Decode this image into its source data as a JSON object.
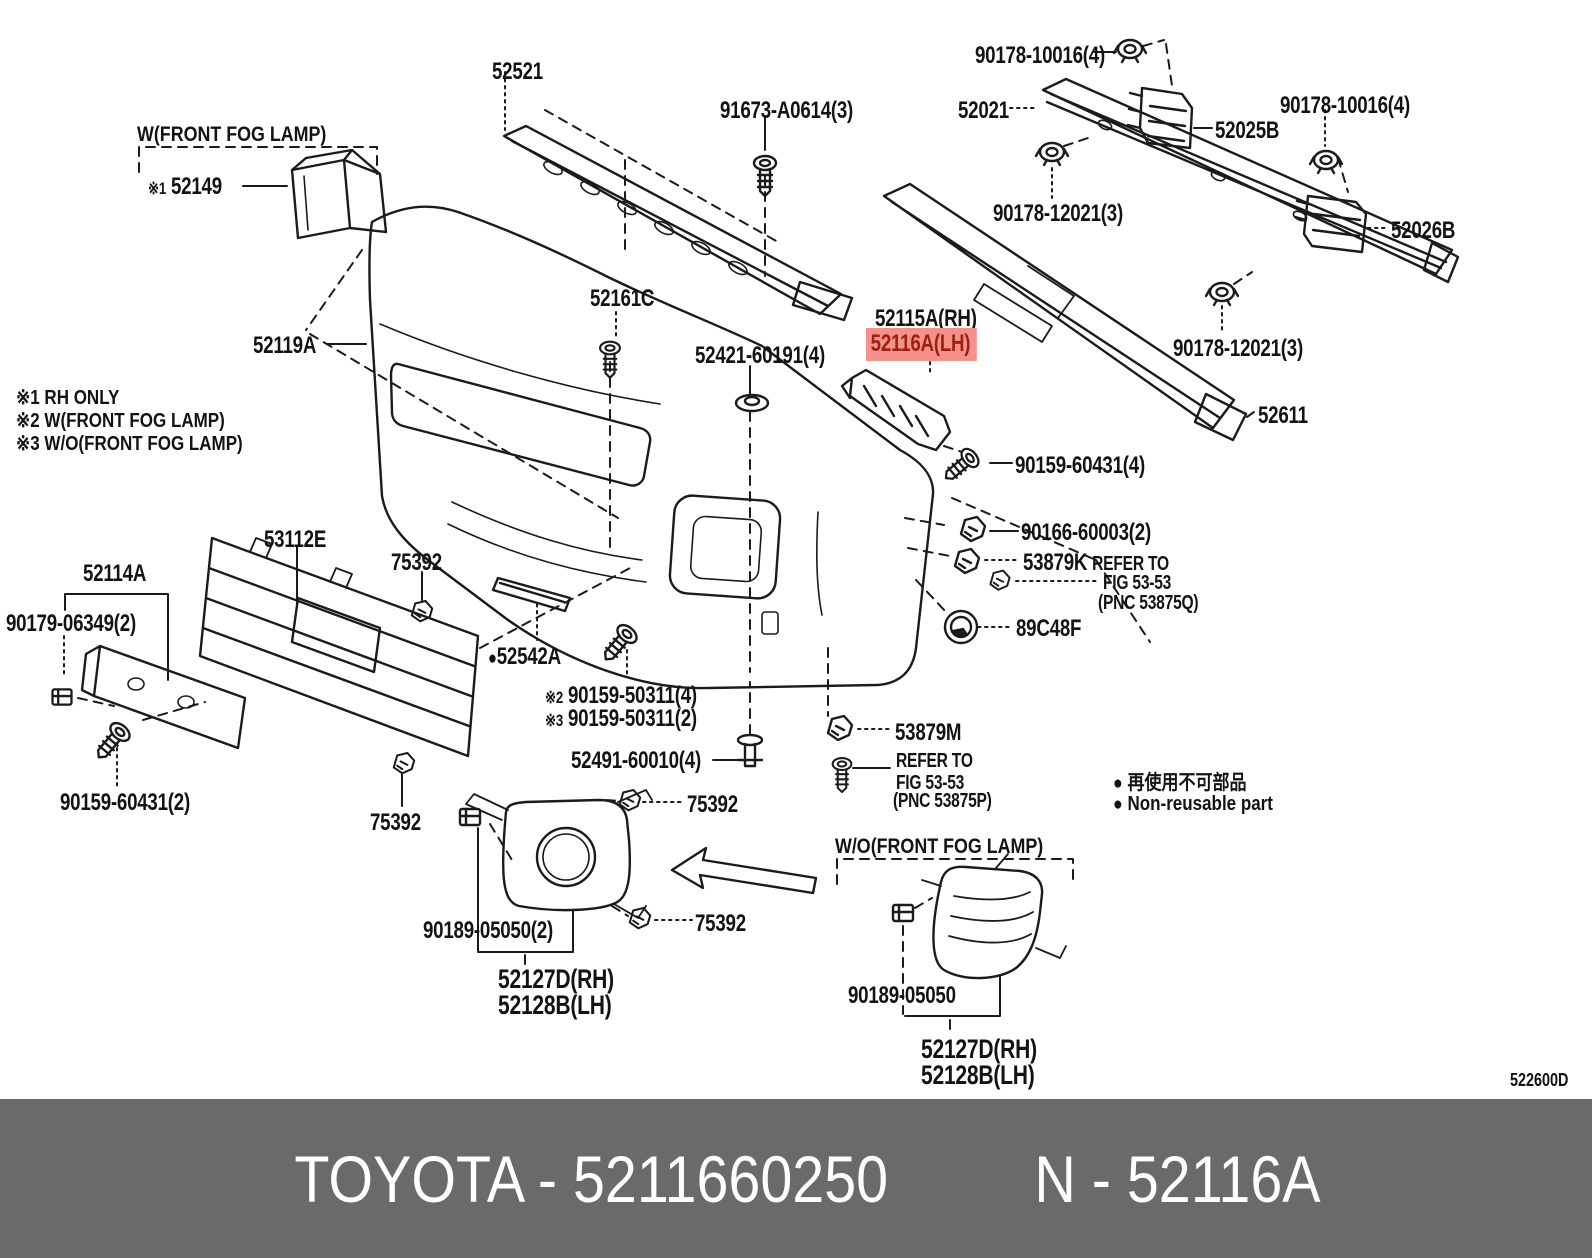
{
  "headers": {
    "with_fog": "W(FRONT FOG LAMP)",
    "without_fog": "W/O(FRONT FOG LAMP)"
  },
  "notes": {
    "n1": "※1 RH ONLY",
    "n2": "※2 W(FRONT FOG LAMP)",
    "n3": "※3 W/O(FRONT FOG LAMP)"
  },
  "legend": {
    "bullet": "●",
    "jp": "再使用不可部品",
    "en": "Non-reusable part"
  },
  "drawing_code": "522600D",
  "footer": {
    "brand_part": "TOYOTA - 5211660250",
    "ref": "N - 52116A"
  },
  "colors": {
    "highlight_bg": "#f4918a",
    "highlight_text": "#9e2015",
    "footer_bg": "#6a6a6a",
    "footer_text": "#ffffff",
    "line": "#1b1b1b"
  },
  "parts": {
    "p52149_prefix": "※1",
    "p52149": "52149",
    "p52521": "52521",
    "p91673": "91673-A0614(3)",
    "p90178_10016_top": "90178-10016(4)",
    "p52021": "52021",
    "p52025B": "52025B",
    "p90178_10016_right": "90178-10016(4)",
    "p52026B": "52026B",
    "p90178_12021_left": "90178-12021(3)",
    "p52161C": "52161C",
    "p52119A": "52119A",
    "p52115A": "52115A(RH)",
    "p52116A": "52116A(LH)",
    "p52421": "52421-60191(4)",
    "p90178_12021_right": "90178-12021(3)",
    "p52611": "52611",
    "p90159_60431_4": "90159-60431(4)",
    "p90166": "90166-60003(2)",
    "p53879K": "53879K",
    "p53879K_note1": "REFER TO",
    "p53879K_note2": "FIG 53-53",
    "p53879K_note3": "(PNC 53875Q)",
    "p89C48F": "89C48F",
    "p52114A": "52114A",
    "p53112E": "53112E",
    "p75392_grille_top": "75392",
    "p90179": "90179-06349(2)",
    "p52542A_bullet": "●",
    "p52542A": "52542A",
    "p90159_50311_4_prefix": "※2",
    "p90159_50311_4": "90159-50311(4)",
    "p90159_50311_2_prefix": "※3",
    "p90159_50311_2": "90159-50311(2)",
    "p90159_60431_2": "90159-60431(2)",
    "p75392_grille_bottom": "75392",
    "p52491": "52491-60010(4)",
    "p53879M": "53879M",
    "p53879M_note1": "REFER TO",
    "p53879M_note2": "FIG 53-53",
    "p53879M_note3": "(PNC 53875P)",
    "p75392_fog_top": "75392",
    "p75392_fog_bottom": "75392",
    "p90189_05050_2": "90189-05050(2)",
    "p52127D_left": "52127D(RH)",
    "p52128B_left": "52128B(LH)",
    "p90189_05050": "90189-05050",
    "p52127D_right": "52127D(RH)",
    "p52128B_right": "52128B(LH)"
  }
}
